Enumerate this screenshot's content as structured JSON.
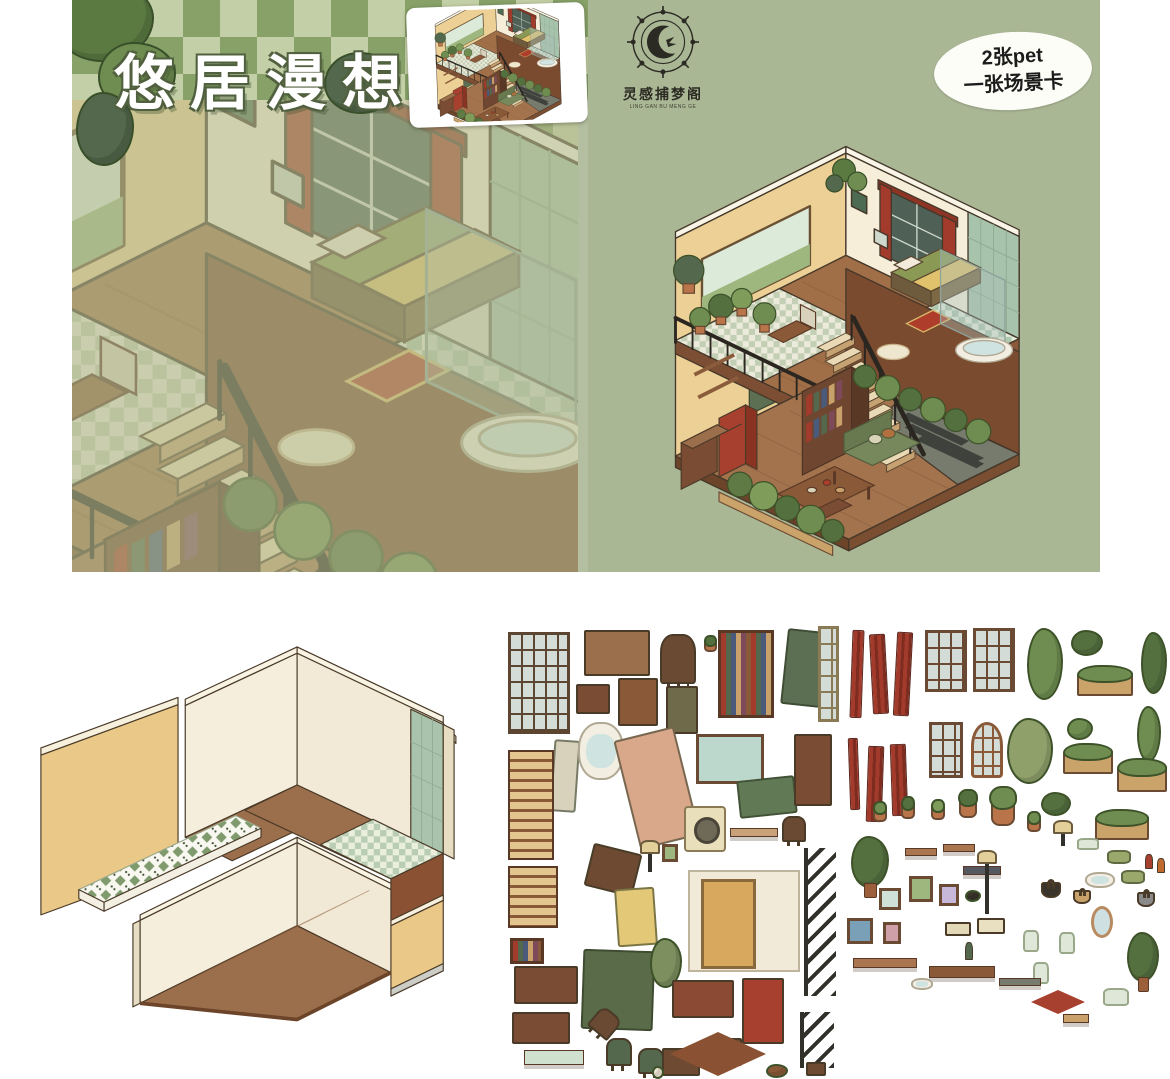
{
  "cover": {
    "title": "悠居漫想",
    "checker_dark": "#87a168",
    "checker_light": "#c3cfa6",
    "scene_tint": "#bdc49a"
  },
  "back_cover": {
    "background": "#aab795",
    "logo": {
      "name_cn": "灵感捕梦阁",
      "name_en": "LING GAN BU MENG GE"
    },
    "badge": {
      "line1": "2张pet",
      "line2": "一张场景卡"
    }
  },
  "palette": {
    "wall_cream": "#f6eed9",
    "wall_tan": "#ecd095",
    "wood": "#a3734e",
    "tile_green": "#a7c3ac",
    "accent_red": "#a23b2b",
    "railing_dark": "#2b2620"
  },
  "sticker_sheets": {
    "furniture": {
      "items": [
        {
          "n": "frosted-window",
          "t": "window",
          "x": 8,
          "y": 10,
          "w": 62,
          "h": 102,
          "c": "#5c4632"
        },
        {
          "n": "table-block",
          "t": "box",
          "x": 84,
          "y": 8,
          "w": 66,
          "h": 46,
          "c": "#9c6f4c"
        },
        {
          "n": "rocking-chair",
          "t": "chair",
          "x": 160,
          "y": 12,
          "w": 36,
          "h": 50,
          "c": "#6b4a33"
        },
        {
          "n": "potted-plant",
          "t": "pot",
          "x": 204,
          "y": 18,
          "w": 13,
          "h": 12,
          "c": "#55703f"
        },
        {
          "n": "bookshelf",
          "t": "books",
          "x": 218,
          "y": 8,
          "w": 56,
          "h": 88
        },
        {
          "n": "green-headboard",
          "t": "panel",
          "x": 284,
          "y": 8,
          "w": 40,
          "h": 76,
          "c": "#5d6f52",
          "r": 6
        },
        {
          "n": "mosaic-panel",
          "t": "window",
          "x": 318,
          "y": 4,
          "w": 21,
          "h": 96,
          "c": "#8a7a55"
        },
        {
          "n": "nightstand",
          "t": "box",
          "x": 76,
          "y": 62,
          "w": 34,
          "h": 30,
          "c": "#7a4c33"
        },
        {
          "n": "sink-vanity",
          "t": "box",
          "x": 118,
          "y": 56,
          "w": 40,
          "h": 48,
          "c": "#8a5a38"
        },
        {
          "n": "floral-cabinet",
          "t": "box",
          "x": 166,
          "y": 64,
          "w": 32,
          "h": 48,
          "c": "#6f6a4a"
        },
        {
          "n": "standing-mirror",
          "t": "panel",
          "x": 52,
          "y": 118,
          "w": 26,
          "h": 72,
          "c": "#d8d2bd",
          "r": 4
        },
        {
          "n": "bathtub",
          "t": "tub",
          "x": 78,
          "y": 100,
          "w": 46,
          "h": 58
        },
        {
          "n": "bed",
          "t": "panel",
          "x": 126,
          "y": 110,
          "w": 62,
          "h": 112,
          "c": "#d9a88a",
          "r": -14
        },
        {
          "n": "landscape-picture",
          "t": "frame",
          "x": 196,
          "y": 112,
          "w": 68,
          "h": 50,
          "c": "#bcd8cc"
        },
        {
          "n": "green-mattress",
          "t": "panel",
          "x": 238,
          "y": 156,
          "w": 58,
          "h": 38,
          "c": "#617a55",
          "r": -6
        },
        {
          "n": "wardrobe",
          "t": "box",
          "x": 294,
          "y": 112,
          "w": 38,
          "h": 72,
          "c": "#7a4c33"
        },
        {
          "n": "air-conditioner",
          "t": "washer",
          "x": 184,
          "y": 184,
          "w": 42,
          "h": 46
        },
        {
          "n": "wall-shelf",
          "t": "shelf",
          "x": 230,
          "y": 206,
          "w": 48,
          "h": 9,
          "c": "#c9a27a"
        },
        {
          "n": "armchair",
          "t": "chair",
          "x": 282,
          "y": 194,
          "w": 24,
          "h": 26,
          "c": "#6b4a33"
        },
        {
          "n": "staircase",
          "t": "stairs",
          "x": 8,
          "y": 128,
          "w": 46,
          "h": 110
        },
        {
          "n": "staircase-small",
          "t": "stairs",
          "x": 8,
          "y": 244,
          "w": 50,
          "h": 62
        },
        {
          "n": "book-stack",
          "t": "books",
          "x": 10,
          "y": 316,
          "w": 34,
          "h": 26
        },
        {
          "n": "floral-sideboard",
          "t": "box",
          "x": 14,
          "y": 344,
          "w": 64,
          "h": 38,
          "c": "#7a4c33"
        },
        {
          "n": "floral-sideboard-2",
          "t": "box",
          "x": 12,
          "y": 390,
          "w": 58,
          "h": 32,
          "c": "#7a4c33"
        },
        {
          "n": "tile-ledge",
          "t": "shelf",
          "x": 24,
          "y": 428,
          "w": 60,
          "h": 15,
          "c": "#cfe0cf"
        },
        {
          "n": "desk",
          "t": "panel",
          "x": 88,
          "y": 226,
          "w": 50,
          "h": 44,
          "c": "#6f4a33",
          "r": 14
        },
        {
          "n": "table-lamp",
          "t": "lamp",
          "x": 148,
          "y": 228,
          "w": 4,
          "h": 22
        },
        {
          "n": "quilt",
          "t": "panel",
          "x": 116,
          "y": 266,
          "w": 40,
          "h": 58,
          "c": "#e3c878",
          "r": -4
        },
        {
          "n": "green-rug",
          "t": "panel",
          "x": 82,
          "y": 328,
          "w": 72,
          "h": 80,
          "c": "#5a6b4a",
          "r": 2
        },
        {
          "n": "moss-piece",
          "t": "plant",
          "x": 150,
          "y": 316,
          "w": 32,
          "h": 50,
          "c": "#7d8f5f"
        },
        {
          "n": "door-with-wall",
          "t": "door",
          "x": 188,
          "y": 248,
          "w": 112,
          "h": 102
        },
        {
          "n": "small-frame",
          "t": "frame",
          "x": 162,
          "y": 222,
          "w": 16,
          "h": 18,
          "c": "#9db77f"
        },
        {
          "n": "kitchen-counter",
          "t": "box",
          "x": 172,
          "y": 358,
          "w": 62,
          "h": 38,
          "c": "#8a4a33"
        },
        {
          "n": "refrigerator",
          "t": "box",
          "x": 242,
          "y": 356,
          "w": 42,
          "h": 66,
          "c": "#a8402f"
        },
        {
          "n": "dining-chair",
          "t": "chair",
          "x": 106,
          "y": 416,
          "w": 26,
          "h": 28,
          "c": "#53684c"
        },
        {
          "n": "dining-chair-2",
          "t": "chair",
          "x": 138,
          "y": 426,
          "w": 26,
          "h": 26,
          "c": "#53684c"
        },
        {
          "n": "fallen-chair",
          "t": "chair",
          "x": 92,
          "y": 388,
          "w": 26,
          "h": 26,
          "c": "#6b4a33",
          "r": 40
        },
        {
          "n": "side-table",
          "t": "box",
          "x": 162,
          "y": 426,
          "w": 38,
          "h": 28,
          "c": "#6f4a33"
        },
        {
          "n": "side-table-2",
          "t": "box",
          "x": 204,
          "y": 416,
          "w": 38,
          "h": 28,
          "c": "#6f4a33"
        },
        {
          "n": "floor-rug",
          "t": "rug",
          "x": 170,
          "y": 410,
          "w": 96,
          "h": 44,
          "c": "#8a5232"
        },
        {
          "n": "stair-railing",
          "t": "ladder",
          "x": 304,
          "y": 226,
          "w": 32,
          "h": 148
        },
        {
          "n": "ladder",
          "t": "ladder",
          "x": 300,
          "y": 390,
          "w": 34,
          "h": 56
        },
        {
          "n": "stool",
          "t": "box",
          "x": 306,
          "y": 440,
          "w": 20,
          "h": 14,
          "c": "#6f4a33"
        },
        {
          "n": "teddy-bear",
          "t": "plant",
          "x": 266,
          "y": 442,
          "w": 22,
          "h": 14,
          "c": "#8a5a38"
        },
        {
          "n": "bunny",
          "t": "plant",
          "x": 152,
          "y": 444,
          "w": 12,
          "h": 13,
          "c": "#f2ead8"
        }
      ]
    },
    "plants_decor": {
      "items": [
        {
          "n": "curtain-strip",
          "t": "curtain",
          "x": 6,
          "y": 8,
          "w": 12,
          "h": 88,
          "r": 2
        },
        {
          "n": "curtain-strip",
          "t": "curtain",
          "x": 26,
          "y": 12,
          "w": 16,
          "h": 80,
          "r": -3
        },
        {
          "n": "curtain-strip",
          "t": "curtain",
          "x": 50,
          "y": 10,
          "w": 16,
          "h": 84,
          "r": 3
        },
        {
          "n": "grid-window",
          "t": "window",
          "x": 80,
          "y": 8,
          "w": 42,
          "h": 62,
          "c": "#6b4a33"
        },
        {
          "n": "grid-window",
          "t": "window",
          "x": 128,
          "y": 6,
          "w": 42,
          "h": 64,
          "c": "#6b4a33"
        },
        {
          "n": "hanging-vine",
          "t": "plant",
          "x": 182,
          "y": 6,
          "w": 36,
          "h": 72,
          "c": "#6f8d50"
        },
        {
          "n": "bush",
          "t": "plant",
          "x": 226,
          "y": 8,
          "w": 32,
          "h": 26,
          "c": "#55703f"
        },
        {
          "n": "planter-box",
          "t": "planter",
          "x": 232,
          "y": 52,
          "w": 56,
          "h": 22
        },
        {
          "n": "hanging-vine",
          "t": "plant",
          "x": 296,
          "y": 10,
          "w": 26,
          "h": 62,
          "c": "#55703f"
        },
        {
          "n": "bush",
          "t": "plant",
          "x": 222,
          "y": 96,
          "w": 26,
          "h": 22,
          "c": "#6f8d50"
        },
        {
          "n": "vine-strand",
          "t": "plant",
          "x": 292,
          "y": 84,
          "w": 24,
          "h": 56,
          "c": "#6f8d50"
        },
        {
          "n": "curtain-strip",
          "t": "curtain",
          "x": 4,
          "y": 116,
          "w": 10,
          "h": 72,
          "r": -2
        },
        {
          "n": "curtain-strip",
          "t": "curtain",
          "x": 22,
          "y": 124,
          "w": 16,
          "h": 76,
          "r": 2
        },
        {
          "n": "curtain-strip",
          "t": "curtain",
          "x": 46,
          "y": 122,
          "w": 16,
          "h": 72,
          "r": -2
        },
        {
          "n": "grid-window-small",
          "t": "window",
          "x": 84,
          "y": 100,
          "w": 34,
          "h": 56,
          "c": "#6b4a33"
        },
        {
          "n": "arched-window",
          "t": "arch",
          "x": 126,
          "y": 100,
          "w": 32,
          "h": 56,
          "c": "#8a5a38"
        },
        {
          "n": "moss-clump",
          "t": "plant",
          "x": 162,
          "y": 96,
          "w": 46,
          "h": 66,
          "c": "#8fa06a"
        },
        {
          "n": "planter-box",
          "t": "planter",
          "x": 218,
          "y": 130,
          "w": 50,
          "h": 22
        },
        {
          "n": "planter-box",
          "t": "planter",
          "x": 272,
          "y": 146,
          "w": 50,
          "h": 24
        },
        {
          "n": "bush",
          "t": "plant",
          "x": 196,
          "y": 170,
          "w": 30,
          "h": 24,
          "c": "#55703f"
        },
        {
          "n": "planter-box",
          "t": "planter",
          "x": 250,
          "y": 196,
          "w": 54,
          "h": 22
        },
        {
          "n": "potted-plant",
          "t": "pot",
          "x": 28,
          "y": 186,
          "w": 14,
          "h": 14,
          "c": "#6f8d50"
        },
        {
          "n": "potted-plant",
          "t": "pot",
          "x": 56,
          "y": 182,
          "w": 14,
          "h": 15,
          "c": "#55703f"
        },
        {
          "n": "potted-plant",
          "t": "pot",
          "x": 86,
          "y": 184,
          "w": 14,
          "h": 14,
          "c": "#7f9c5b"
        },
        {
          "n": "potted-plant",
          "t": "pot",
          "x": 114,
          "y": 178,
          "w": 18,
          "h": 18,
          "c": "#55703f"
        },
        {
          "n": "potted-plant-large",
          "t": "pot",
          "x": 146,
          "y": 180,
          "w": 24,
          "h": 24,
          "c": "#6f8d50"
        },
        {
          "n": "hanging-pot",
          "t": "pot",
          "x": 182,
          "y": 196,
          "w": 14,
          "h": 14,
          "c": "#6f8d50"
        },
        {
          "n": "mushroom-lamp",
          "t": "lamp",
          "x": 216,
          "y": 208,
          "w": 4,
          "h": 16
        },
        {
          "n": "fruit-bowl",
          "t": "jar",
          "x": 232,
          "y": 216,
          "w": 22,
          "h": 12
        },
        {
          "n": "cushion",
          "t": "pillow",
          "x": 262,
          "y": 228,
          "w": 24,
          "h": 14
        },
        {
          "n": "cushion",
          "t": "pillow",
          "x": 276,
          "y": 248,
          "w": 24,
          "h": 14
        },
        {
          "n": "pet-bed",
          "t": "tub",
          "x": 240,
          "y": 250,
          "w": 30,
          "h": 16
        },
        {
          "n": "sauce-bottle",
          "t": "bottle",
          "x": 300,
          "y": 232,
          "w": 8,
          "h": 15,
          "c": "#a8402f"
        },
        {
          "n": "sauce-bottle",
          "t": "bottle",
          "x": 312,
          "y": 236,
          "w": 8,
          "h": 15,
          "c": "#c06a2f"
        },
        {
          "n": "tall-plant",
          "t": "tree",
          "x": 6,
          "y": 214,
          "w": 38,
          "h": 52,
          "c": "#55703f"
        },
        {
          "n": "wall-shelf",
          "t": "shelf",
          "x": 60,
          "y": 226,
          "w": 32,
          "h": 8,
          "c": "#a9764f"
        },
        {
          "n": "wall-shelf",
          "t": "shelf",
          "x": 98,
          "y": 222,
          "w": 32,
          "h": 8,
          "c": "#a9764f"
        },
        {
          "n": "dark-shelf",
          "t": "shelf",
          "x": 118,
          "y": 244,
          "w": 38,
          "h": 9,
          "c": "#55585e"
        },
        {
          "n": "picture-frame",
          "t": "frame",
          "x": 34,
          "y": 266,
          "w": 22,
          "h": 22,
          "c": "#cfe0d8"
        },
        {
          "n": "picture-frame",
          "t": "frame",
          "x": 64,
          "y": 254,
          "w": 24,
          "h": 26,
          "c": "#9db77f"
        },
        {
          "n": "picture-frame",
          "t": "frame",
          "x": 94,
          "y": 262,
          "w": 20,
          "h": 22,
          "c": "#c7b7d8"
        },
        {
          "n": "cat-silhouette",
          "t": "plant",
          "x": 120,
          "y": 268,
          "w": 16,
          "h": 12,
          "c": "#3a342c"
        },
        {
          "n": "floor-lamp",
          "t": "lamp",
          "x": 140,
          "y": 238,
          "w": 4,
          "h": 54
        },
        {
          "n": "picture-frame",
          "t": "frame",
          "x": 2,
          "y": 296,
          "w": 26,
          "h": 26,
          "c": "#7aa0b8"
        },
        {
          "n": "picture-frame",
          "t": "frame",
          "x": 38,
          "y": 300,
          "w": 18,
          "h": 22,
          "c": "#cfa0a8"
        },
        {
          "n": "tissue-box",
          "t": "box",
          "x": 100,
          "y": 300,
          "w": 26,
          "h": 14,
          "c": "#e3d8b8"
        },
        {
          "n": "tissue-box",
          "t": "box",
          "x": 132,
          "y": 296,
          "w": 28,
          "h": 16,
          "c": "#e9e0c2"
        },
        {
          "n": "handbag",
          "t": "bag",
          "x": 196,
          "y": 260,
          "w": 20,
          "h": 16,
          "c": "#3a342c"
        },
        {
          "n": "basket-bag",
          "t": "bag",
          "x": 228,
          "y": 268,
          "w": 18,
          "h": 14,
          "c": "#c9a26b"
        },
        {
          "n": "handbag-2",
          "t": "bag",
          "x": 292,
          "y": 270,
          "w": 18,
          "h": 15,
          "c": "#8a8a8a"
        },
        {
          "n": "wine-bottle",
          "t": "bottle",
          "x": 120,
          "y": 320,
          "w": 8,
          "h": 18,
          "c": "#53684c"
        },
        {
          "n": "glass-jar",
          "t": "jar",
          "x": 178,
          "y": 308,
          "w": 16,
          "h": 22
        },
        {
          "n": "glass-jar",
          "t": "jar",
          "x": 214,
          "y": 310,
          "w": 16,
          "h": 22
        },
        {
          "n": "glass-jar",
          "t": "jar",
          "x": 188,
          "y": 340,
          "w": 16,
          "h": 22
        },
        {
          "n": "oval-mirror",
          "t": "mirror",
          "x": 246,
          "y": 284,
          "w": 22,
          "h": 32
        },
        {
          "n": "potted-tree",
          "t": "tree",
          "x": 282,
          "y": 310,
          "w": 32,
          "h": 50,
          "c": "#55703f"
        },
        {
          "n": "shelf-plank",
          "t": "shelf",
          "x": 8,
          "y": 336,
          "w": 64,
          "h": 10,
          "c": "#a9764f"
        },
        {
          "n": "shelf-plank",
          "t": "shelf",
          "x": 84,
          "y": 344,
          "w": 66,
          "h": 12,
          "c": "#8a5a38"
        },
        {
          "n": "shelf-plank",
          "t": "shelf",
          "x": 154,
          "y": 356,
          "w": 42,
          "h": 8,
          "c": "#777b6e"
        },
        {
          "n": "red-rug",
          "t": "rug",
          "x": 186,
          "y": 368,
          "w": 54,
          "h": 24,
          "c": "#a8402f"
        },
        {
          "n": "storage-basket",
          "t": "jar",
          "x": 258,
          "y": 366,
          "w": 26,
          "h": 18
        },
        {
          "n": "tray",
          "t": "shelf",
          "x": 218,
          "y": 392,
          "w": 26,
          "h": 9,
          "c": "#c9a26b"
        },
        {
          "n": "sun-hat",
          "t": "tub",
          "x": 66,
          "y": 356,
          "w": 22,
          "h": 12
        }
      ]
    }
  }
}
